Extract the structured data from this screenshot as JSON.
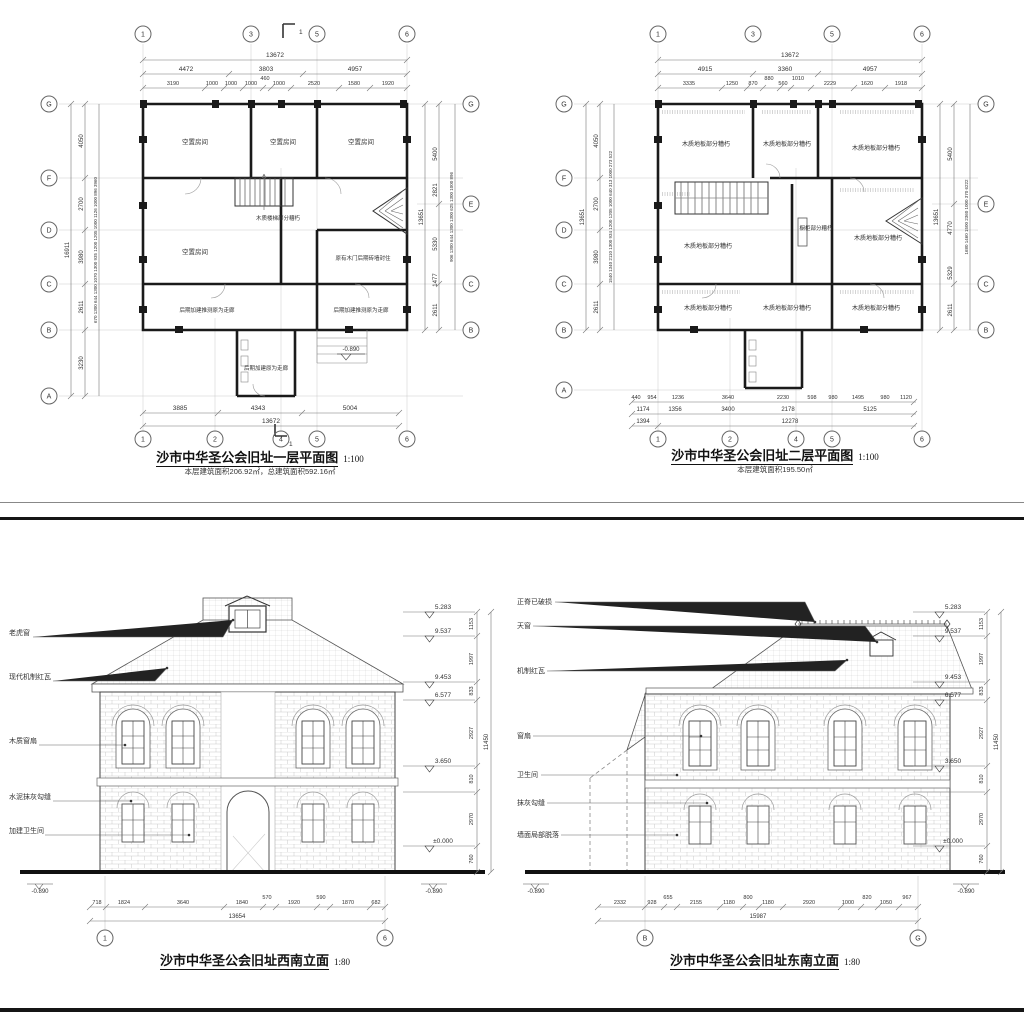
{
  "plan1": {
    "title": "沙市中华圣公会旧址一层平面图",
    "scale": "1:100",
    "subtitle": "本层建筑面积206.92㎡，总建筑面积592.16㎡",
    "section_mark": "1",
    "grid_top": [
      "1",
      "3",
      "5",
      "6"
    ],
    "grid_bottom": [
      "1",
      "2",
      "4",
      "5",
      "6"
    ],
    "grid_left": [
      "G",
      "F",
      "D",
      "C",
      "B",
      "A"
    ],
    "grid_right": [
      "G",
      "E",
      "C",
      "B"
    ],
    "dim_top_total": "13672",
    "dims_top_major": [
      "4472",
      "3803",
      "4957"
    ],
    "dims_top_minor": [
      "3190",
      "1000",
      "1000",
      "1000",
      "460",
      "1000",
      "2520",
      "1580",
      "1920"
    ],
    "dims_bottom": [
      "3885",
      "4343",
      "5004"
    ],
    "dim_bottom_total": "13672",
    "dim_left_total": "16911",
    "dims_left_major": [
      "4050",
      "2700",
      "3980",
      "2611",
      "3230"
    ],
    "dims_left_minor": [
      "670",
      "1300",
      "644",
      "1300",
      "1070",
      "1300",
      "935",
      "1200",
      "1205",
      "1000",
      "1126",
      "1000",
      "896",
      "3960"
    ],
    "dim_right_total": "13651",
    "dims_right_major": [
      "5400",
      "2821",
      "5330",
      "1477",
      "2611"
    ],
    "dims_right_minor": [
      "906",
      "1300",
      "644",
      "1300",
      "1300",
      "625",
      "1300",
      "1000",
      "896"
    ],
    "rooms": [
      "空置房间",
      "空置房间",
      "空置房间",
      "空置房间"
    ],
    "note_stair": "木质楼梯部分糟朽",
    "note_door": "原有木门后期砖墙封住",
    "note_corridor1": "后期加建推测原为走廊",
    "note_corridor2": "后期加建推测原为走廊",
    "note_corridor3": "后期加建原为走廊",
    "level": "-0.890"
  },
  "plan2": {
    "title": "沙市中华圣公会旧址二层平面图",
    "scale": "1:100",
    "subtitle": "本层建筑面积195.50㎡",
    "grid_top": [
      "1",
      "3",
      "5",
      "6"
    ],
    "grid_bottom": [
      "1",
      "2",
      "4",
      "5",
      "6"
    ],
    "grid_left": [
      "G",
      "F",
      "D",
      "C",
      "B",
      "A"
    ],
    "grid_right": [
      "G",
      "E",
      "C",
      "B"
    ],
    "dim_top_total": "13672",
    "dims_top_major": [
      "4915",
      "3360",
      "4957"
    ],
    "dims_top_minor": [
      "3335",
      "1250",
      "870",
      "880",
      "560",
      "1010",
      "2229",
      "1620",
      "1918"
    ],
    "dims_bottom_minor": [
      "440",
      "954",
      "1236",
      "3640",
      "2230",
      "598",
      "980",
      "1495",
      "980",
      "1120"
    ],
    "dims_bottom_major": [
      "1174",
      "1356",
      "3400",
      "2178",
      "5125"
    ],
    "dims_bottom_outer": [
      "1394",
      "12278"
    ],
    "dim_left_total": "13651",
    "dims_left_major": [
      "4050",
      "2700",
      "3980",
      "2611"
    ],
    "dims_left_minor": [
      "1540",
      "1340",
      "2110",
      "1300",
      "934",
      "1200",
      "1205",
      "1000",
      "640",
      "313",
      "1000",
      "273",
      "522"
    ],
    "dim_right_total": "13651",
    "dims_right_major": [
      "5400",
      "4770",
      "5329",
      "2611"
    ],
    "dims_right_minor": [
      "1680",
      "1460",
      "1500",
      "2360",
      "1000",
      "370",
      "6222"
    ],
    "rooms": [
      "木质地板部分糟朽",
      "木质地板部分糟朽",
      "木质地板部分糟朽",
      "木质地板部分糟朽",
      "木质地板部分糟朽",
      "木质地板部分糟朽",
      "木质地板部分糟朽",
      "木质地板部分糟朽"
    ],
    "note_cabinet": "橱柜部分糟朽"
  },
  "elev_sw": {
    "title": "沙市中华圣公会旧址西南立面",
    "scale": "1:80",
    "labels": [
      "老虎窗",
      "现代机制红瓦",
      "木质窗扇",
      "水泥抹灰勾缝",
      "加建卫生间"
    ],
    "levels": [
      "5.283",
      "9.537",
      "9.453",
      "6.577",
      "3.650",
      "±0.000"
    ],
    "level_ground": "-0.890",
    "vdims": [
      "1153",
      "1997",
      "833",
      "2927",
      "810",
      "2970",
      "760"
    ],
    "vdim_total": "11450",
    "dims_bottom": [
      "718",
      "1824",
      "3640",
      "1840",
      "570",
      "1920",
      "590",
      "1870",
      "682"
    ],
    "dim_bottom_total": "13654",
    "grid_left_label": "1",
    "grid_right_label": "6"
  },
  "elev_se": {
    "title": "沙市中华圣公会旧址东南立面",
    "scale": "1:80",
    "labels": [
      "正脊已破损",
      "天窗",
      "机制红瓦",
      "窗扇",
      "卫生间",
      "抹灰勾缝",
      "墙面局部脱落"
    ],
    "levels": [
      "5.283",
      "9.537",
      "9.453",
      "6.577",
      "3.650",
      "±0.000"
    ],
    "level_ground": "-0.890",
    "vdims": [
      "1153",
      "1997",
      "833",
      "2927",
      "810",
      "2970",
      "760"
    ],
    "vdim_total": "11450",
    "dims_bottom": [
      "2332",
      "928",
      "655",
      "2155",
      "1180",
      "800",
      "1180",
      "2920",
      "1000",
      "820",
      "1050",
      "967"
    ],
    "dim_bottom_total": "15987",
    "grid_left_label": "B",
    "grid_right_label": "G"
  }
}
